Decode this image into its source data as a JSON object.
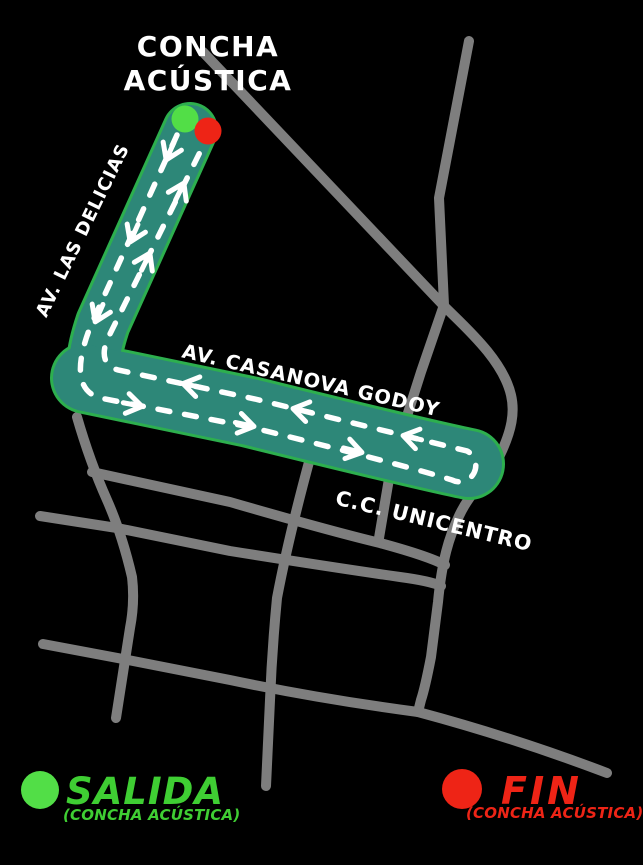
{
  "title": {
    "line1": "CONCHA",
    "line2": "ACÚSTICA"
  },
  "streets": {
    "las_delicias": "AV. LAS DELICIAS",
    "casanova_godoy": "AV. CASANOVA GODOY",
    "unicentro": "C.C. UNICENTRO"
  },
  "legend": {
    "start": {
      "label": "SALIDA",
      "detail": "(CONCHA ACÚSTICA)",
      "text_color": "#3fce33",
      "marker_color": "#52de47"
    },
    "finish": {
      "label": "FIN",
      "detail": "(CONCHA ACÚSTICA)",
      "text_color": "#ee2416",
      "marker_color": "#ee2416"
    }
  },
  "route": {
    "fill_color": "#2d8778",
    "border_color": "#2daf4e",
    "lane_marking_color": "#ffffff",
    "start_marker_color": "#52de47",
    "finish_marker_color": "#ee2416"
  },
  "roads": {
    "color": "#7e7e7e"
  },
  "background_color": "#000000"
}
